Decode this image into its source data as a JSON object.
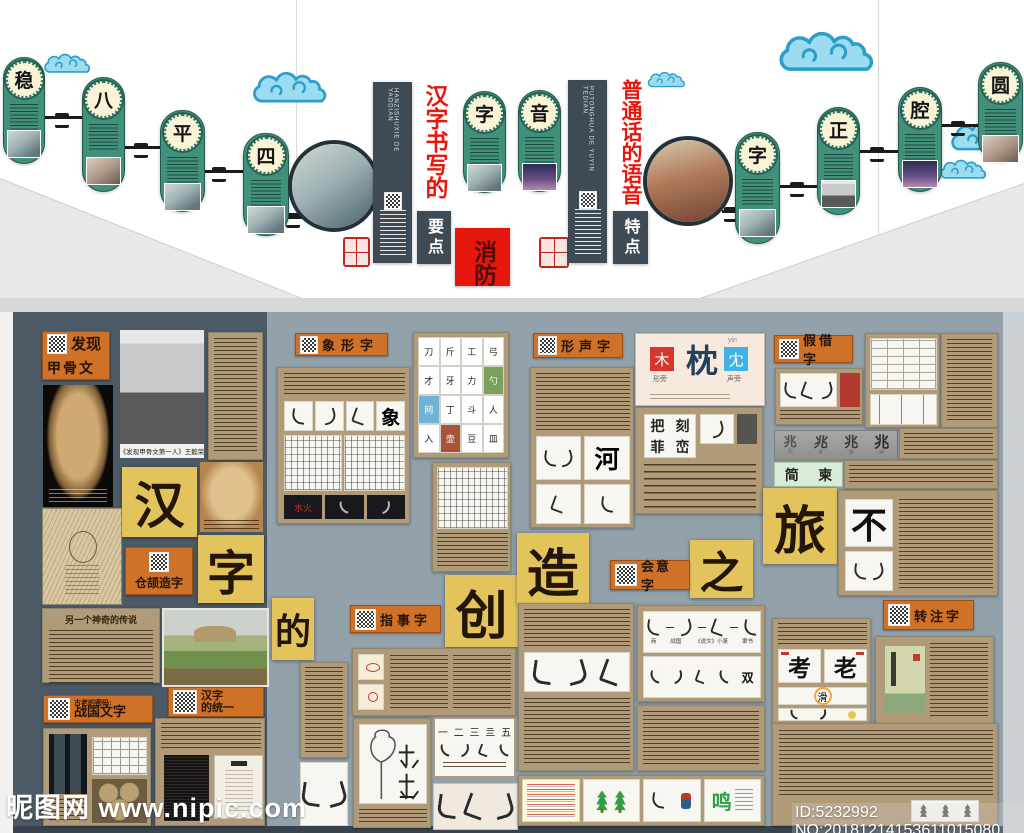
{
  "watermark": {
    "site": "昵图网 www.nipic.com",
    "id": "ID:5232992 NO:20181214153611015080"
  },
  "wall": {
    "en_left": "HANZISHUXIE DE YAODIAN",
    "en_right": "PUTONGHUA DE YUYIN TEDIAN",
    "title_left": "汉字书写的",
    "sub_left": "要点",
    "title_right": "普通话的语音",
    "sub_right": "特点",
    "fire_box": "消防",
    "left_capsules": [
      "稳",
      "八",
      "平",
      "四"
    ],
    "center_capsules": [
      "字",
      "音"
    ],
    "right_capsules": [
      "字",
      "正",
      "腔",
      "圆"
    ]
  },
  "board": {
    "title_chars": [
      "汉",
      "字",
      "的",
      "创",
      "造",
      "之",
      "旅"
    ],
    "labels": {
      "faxian1": "发现",
      "faxian2": "甲骨文",
      "xiangxing": "象形字",
      "xingsheng": "形声字",
      "jiajie": "假借字",
      "cangjie": "仓颉造字",
      "zhishi": "指事字",
      "huiyi": "会意字",
      "zhuanzhu": "转注字",
      "zhanguo1": "古老的密码:",
      "zhanguo2": "战国文字",
      "tongyi1": "汉字",
      "tongyi2": "的统一"
    },
    "captions": {
      "wang": "《发现甲骨文第一人》王懿荣",
      "legend": "另一个神奇的传说"
    },
    "xiangxing": {
      "elephant": "象",
      "fire_water": "水火",
      "tools": [
        "刀",
        "斤",
        "工",
        "弓",
        "才",
        "牙",
        "力",
        "勺",
        "网",
        "丁",
        "斗",
        "人",
        "入",
        "壶",
        "豆",
        "皿"
      ]
    },
    "xingsheng": {
      "he": "河",
      "left": "木",
      "center": "枕",
      "right": "冘",
      "pinyin": "yin",
      "left_tag": "形旁",
      "right_tag": "声旁",
      "grid": [
        "把",
        "刻",
        "菲",
        "峦"
      ]
    },
    "jiajie": {
      "zhao": "兆",
      "nums": [
        "①",
        "②",
        "③",
        "④"
      ],
      "jian": "简",
      "dong": "柬",
      "bu": "不"
    },
    "zhishi": {
      "numbers": [
        "一",
        "二",
        "三",
        "亖",
        "五"
      ]
    },
    "huiyi": {
      "stages": [
        "商",
        "战国",
        "《说文》小篆",
        "隶书"
      ],
      "shuang": "双",
      "ming": "鸣"
    },
    "zhuanzhu": {
      "kao": "考",
      "lao": "老",
      "hua": "滑"
    }
  }
}
